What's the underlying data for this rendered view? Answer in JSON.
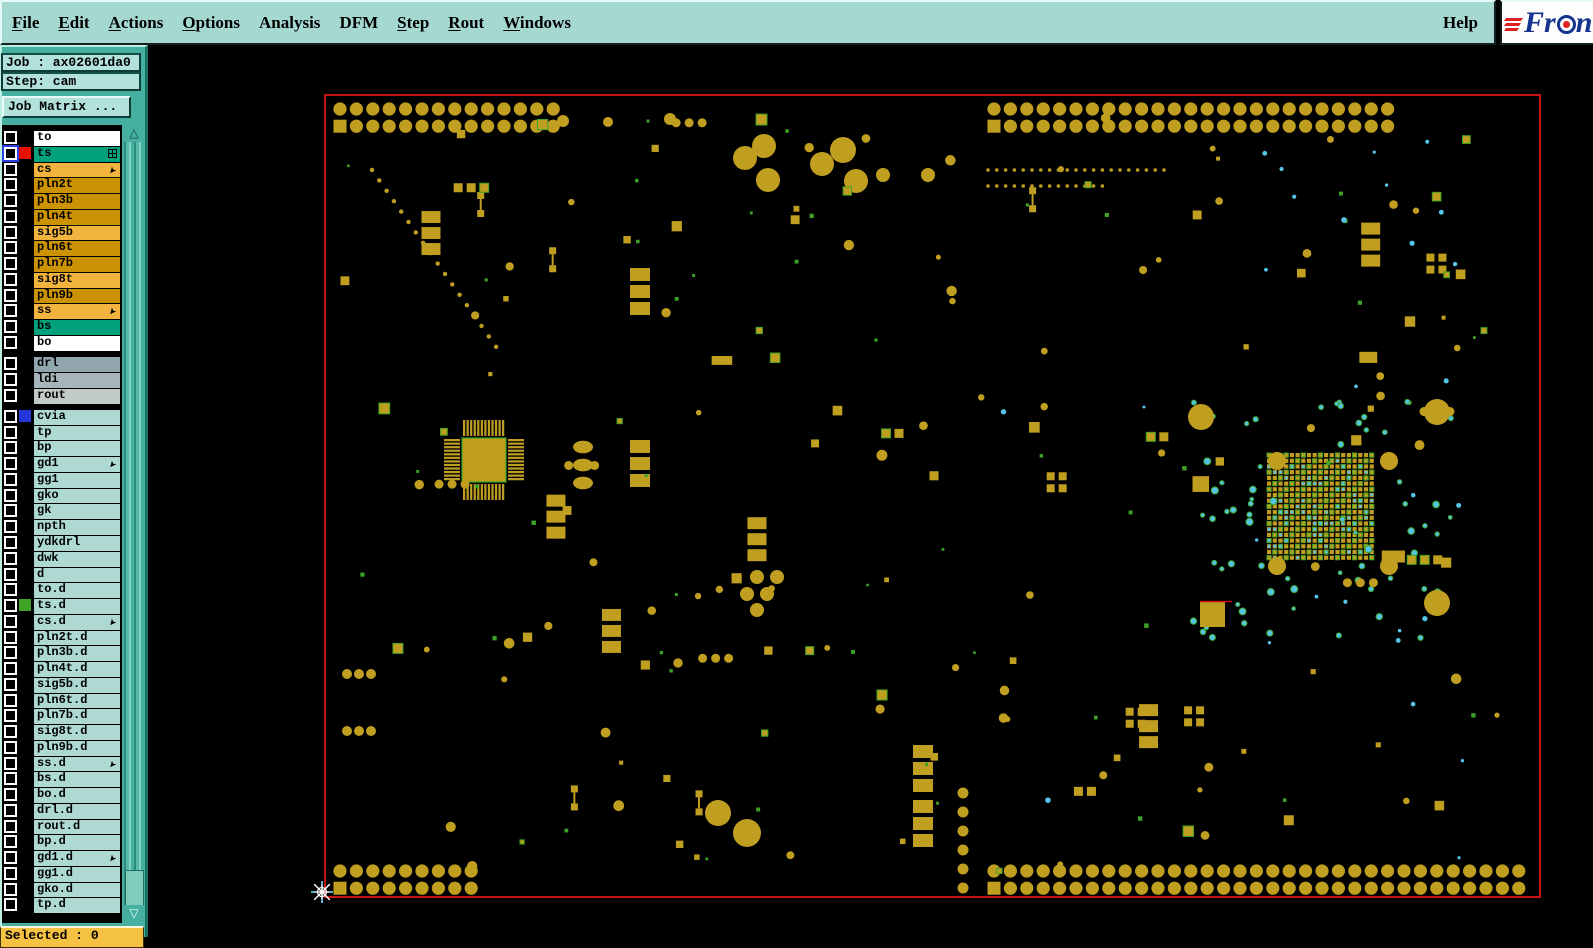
{
  "menu": {
    "items": [
      {
        "label": "File",
        "u": 0
      },
      {
        "label": "Edit",
        "u": 0
      },
      {
        "label": "Actions",
        "u": 0
      },
      {
        "label": "Options",
        "u": 0
      },
      {
        "label": "Analysis",
        "u": -1
      },
      {
        "label": "DFM",
        "u": -1
      },
      {
        "label": "Step",
        "u": 0
      },
      {
        "label": "Rout",
        "u": 0
      },
      {
        "label": "Windows",
        "u": 0
      }
    ],
    "help": "Help"
  },
  "logo": {
    "prefix": "Fr",
    "suffix": "n"
  },
  "sidebar": {
    "job_line": "Job : ax02601da0",
    "step_line": "Step: cam",
    "matrix_button": "Job Matrix ...",
    "selected_line": "Selected : 0",
    "row_colors": {
      "white": "#ffffff",
      "teal": "#00a17b",
      "orange": "#f2b43e",
      "gold": "#cb9204",
      "gray1": "#91a7ad",
      "gray2": "#a6b5ba",
      "gray3": "#c2cac9",
      "cyan": "#aed9d3"
    },
    "groups": [
      {
        "rows": [
          {
            "label": "to",
            "bg": "white"
          },
          {
            "label": "ts",
            "bg": "teal",
            "swatch": "#e81000",
            "icon": "grid",
            "ring": true
          },
          {
            "label": "cs",
            "bg": "orange",
            "icon": "arrow"
          },
          {
            "label": "pln2t",
            "bg": "gold"
          },
          {
            "label": "pln3b",
            "bg": "gold"
          },
          {
            "label": "pln4t",
            "bg": "gold"
          },
          {
            "label": "sig5b",
            "bg": "orange"
          },
          {
            "label": "pln6t",
            "bg": "gold"
          },
          {
            "label": "pln7b",
            "bg": "gold"
          },
          {
            "label": "sig8t",
            "bg": "orange"
          },
          {
            "label": "pln9b",
            "bg": "gold"
          },
          {
            "label": "ss",
            "bg": "orange",
            "icon": "arrow"
          },
          {
            "label": "bs",
            "bg": "teal"
          },
          {
            "label": "bo",
            "bg": "white"
          }
        ]
      },
      {
        "rows": [
          {
            "label": "drl",
            "bg": "gray1"
          },
          {
            "label": "ldi",
            "bg": "gray2"
          },
          {
            "label": "rout",
            "bg": "gray3"
          }
        ]
      },
      {
        "rows": [
          {
            "label": "cvia",
            "bg": "cyan",
            "swatch": "#2536d8"
          },
          {
            "label": "tp",
            "bg": "cyan"
          },
          {
            "label": "bp",
            "bg": "cyan"
          },
          {
            "label": "gd1",
            "bg": "cyan",
            "icon": "arrow"
          },
          {
            "label": "gg1",
            "bg": "cyan"
          },
          {
            "label": "gko",
            "bg": "cyan"
          },
          {
            "label": "gk",
            "bg": "cyan"
          },
          {
            "label": "npth",
            "bg": "cyan"
          },
          {
            "label": "ydkdrl",
            "bg": "cyan"
          },
          {
            "label": "dwk",
            "bg": "cyan"
          },
          {
            "label": "d",
            "bg": "cyan"
          },
          {
            "label": "to.d",
            "bg": "cyan"
          },
          {
            "label": "ts.d",
            "bg": "cyan",
            "swatch": "#3fa326"
          },
          {
            "label": "cs.d",
            "bg": "cyan",
            "icon": "arrow"
          },
          {
            "label": "pln2t.d",
            "bg": "cyan"
          },
          {
            "label": "pln3b.d",
            "bg": "cyan"
          },
          {
            "label": "pln4t.d",
            "bg": "cyan"
          },
          {
            "label": "sig5b.d",
            "bg": "cyan"
          },
          {
            "label": "pln6t.d",
            "bg": "cyan"
          },
          {
            "label": "pln7b.d",
            "bg": "cyan"
          },
          {
            "label": "sig8t.d",
            "bg": "cyan"
          },
          {
            "label": "pln9b.d",
            "bg": "cyan"
          },
          {
            "label": "ss.d",
            "bg": "cyan",
            "icon": "arrow"
          },
          {
            "label": "bs.d",
            "bg": "cyan"
          },
          {
            "label": "bo.d",
            "bg": "cyan"
          },
          {
            "label": "drl.d",
            "bg": "cyan"
          },
          {
            "label": "rout.d",
            "bg": "cyan"
          },
          {
            "label": "bp.d",
            "bg": "cyan"
          },
          {
            "label": "gd1.d",
            "bg": "cyan",
            "icon": "arrow"
          },
          {
            "label": "gg1.d",
            "bg": "cyan"
          },
          {
            "label": "gko.d",
            "bg": "cyan"
          },
          {
            "label": "tp.d",
            "bg": "cyan"
          }
        ]
      }
    ]
  },
  "pcb": {
    "background": "#000000",
    "border_color": "#c31313",
    "pad_color": "#c09e20",
    "green": "#3da326",
    "cyan": "#55c4e6",
    "cursor_color": "#ffffff",
    "seed": 20130217
  }
}
